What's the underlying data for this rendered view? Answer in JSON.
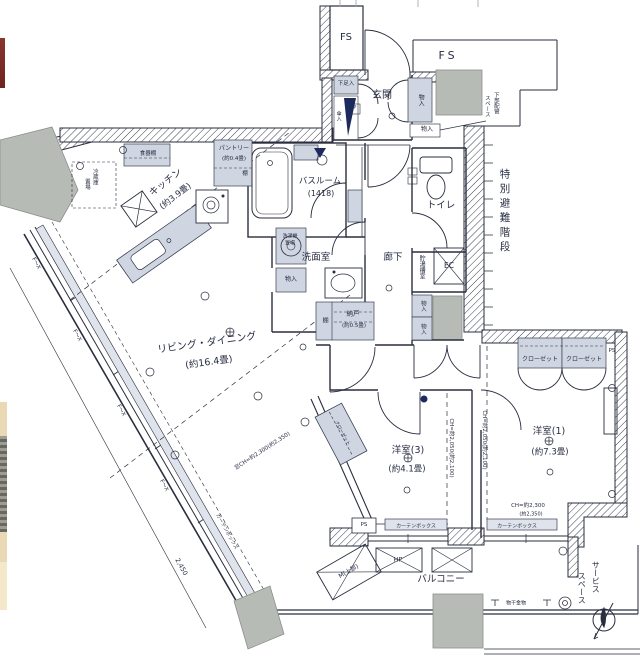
{
  "plan": {
    "type": "apartment-floor-plan",
    "colors": {
      "paper": "#ffffff",
      "ink": "#2a2e3e",
      "fixture_shade": "#cfd6e2",
      "column_gray": "#b7bbb5",
      "navy_accent": "#1d2a5e",
      "photo_red": "#7d2a25",
      "photo_beige": "#e9d9b5"
    },
    "t": {
      "fs": "FS",
      "genkan": "玄関",
      "getabako": "下足入",
      "kasaire": "傘入",
      "p": "P",
      "monoire": "物入",
      "haikan_a": "下部配管",
      "haikan_b": "スペース",
      "hinan": "特別避難階段",
      "toire": "トイレ",
      "chotoso": "貯湯槽室",
      "ec": "EC",
      "pantry": "パントリー",
      "pantry_size": "(約0.4畳)",
      "tana": "棚",
      "shokkidana": "食器棚",
      "reizoko_a": "冷蔵庫",
      "reizoko_b": "置場",
      "kitchen": "キッチン",
      "kitchen_size": "(約3.9畳)",
      "bathroom": "バスルーム",
      "bathroom_size": "(1418)",
      "sentakuki_a": "洗濯機",
      "sentakuki_b": "置場",
      "senmen": "洗面室",
      "rouka": "廊下",
      "nando": "納戸",
      "nando_size": "(約0.5畳)",
      "living": "リビング・ダイニング",
      "living_size": "(約16.4畳)",
      "mado_ch": "窓CH=約2,300(約2,350)",
      "yoshitsu3": "洋室(3)",
      "yoshitsu3_size": "(約4.1畳)",
      "ch_low": "CH=約2,050(約2,100)",
      "yoshitsu1": "洋室(1)",
      "yoshitsu1_size": "(約7.3畳)",
      "closet": "クローゼット",
      "ps": "PS",
      "ch_a": "CH=約2,300",
      "ch_b": "(約2,350)",
      "curtain": "カーテンボックス",
      "m_ue": "M(上部)",
      "hp": "HP",
      "balcony": "バルコニー",
      "monohoshi": "物干金物",
      "service_a": "サービス",
      "service_b": "スペース",
      "dim_2450": "2,450",
      "fix_window": "F～X"
    }
  }
}
